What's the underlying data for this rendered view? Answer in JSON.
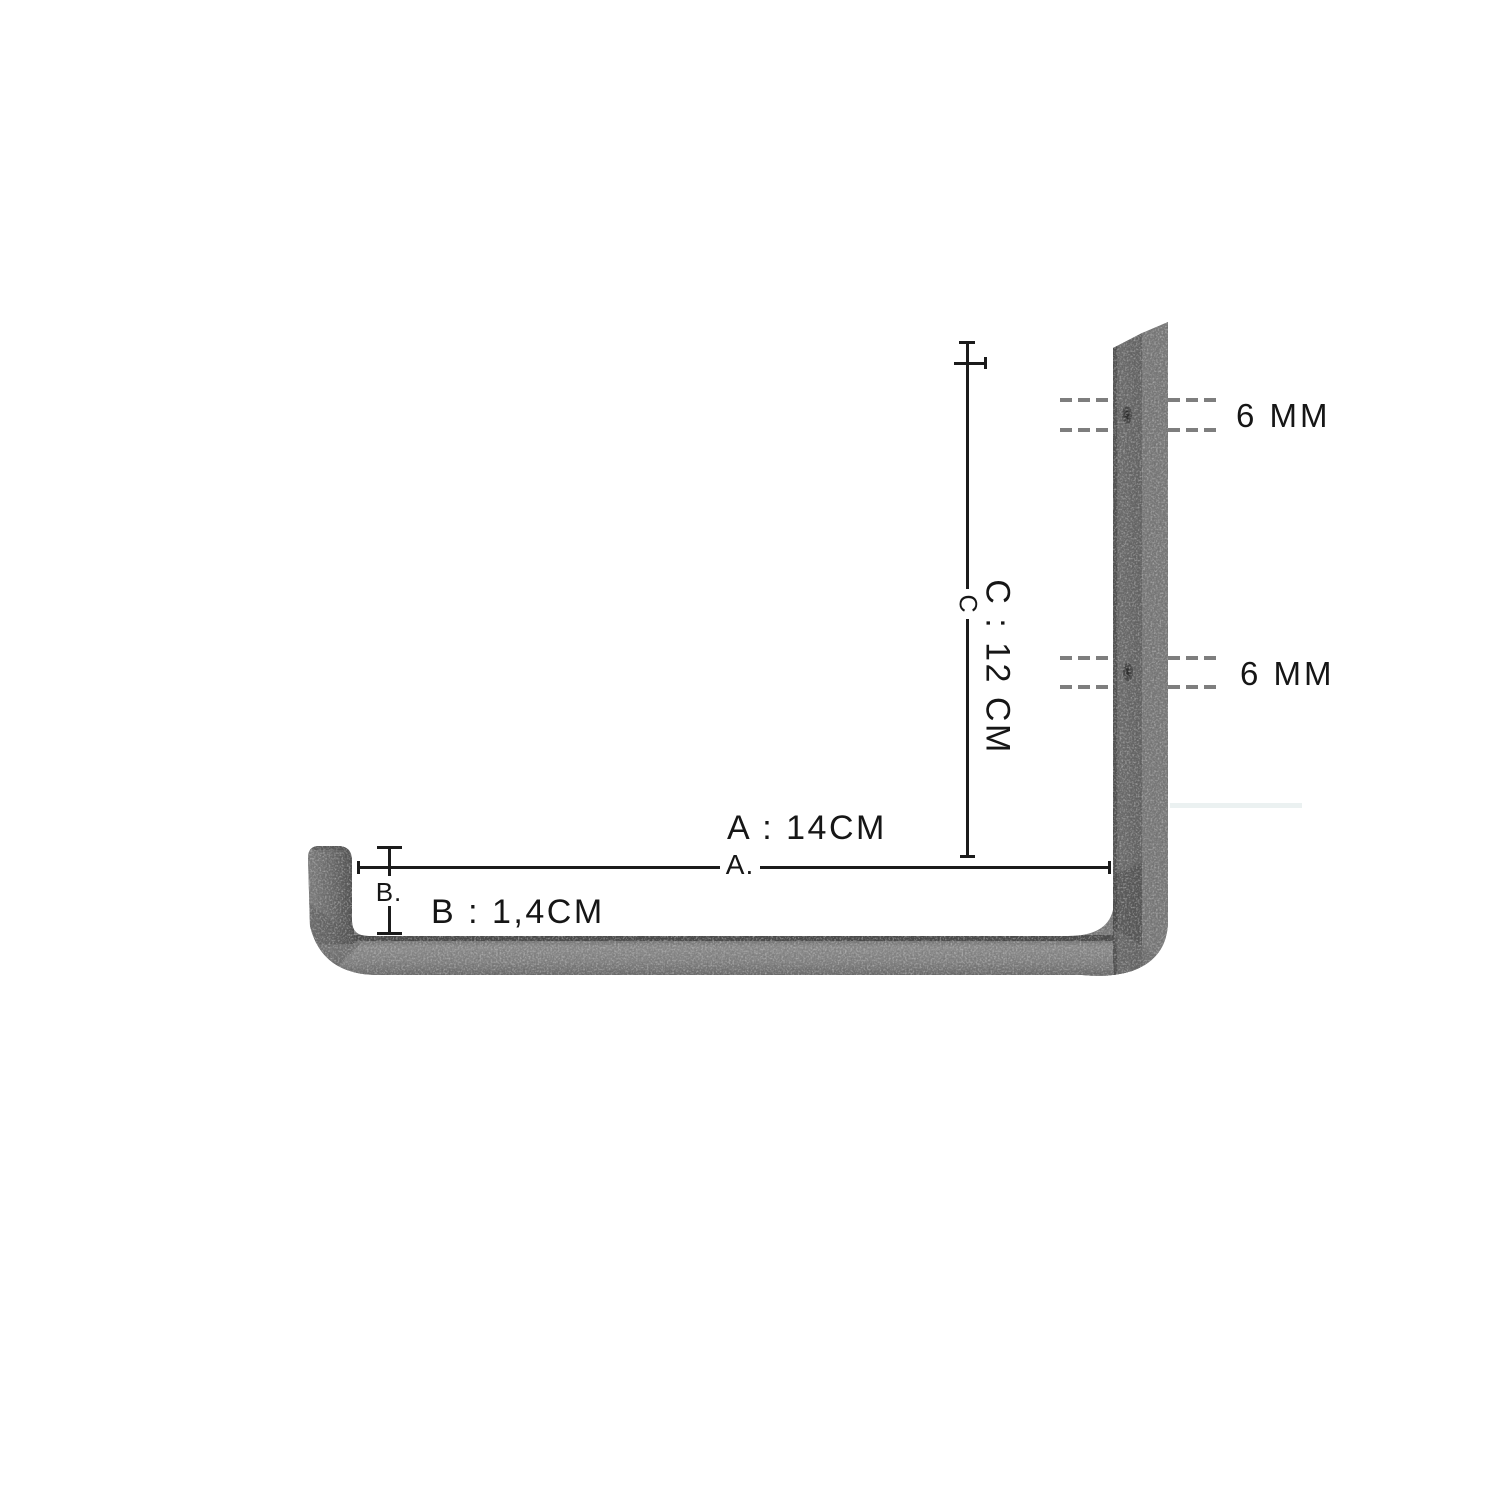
{
  "diagram": {
    "dim_a": {
      "label": "A : 14CM",
      "line_label": "A."
    },
    "dim_b": {
      "label": "B : 1,4CM",
      "line_label": "B."
    },
    "dim_c": {
      "label": "C : 12 CM",
      "line_label": "C"
    },
    "hole_top": {
      "label": "6 MM"
    },
    "hole_bottom": {
      "label": "6 MM"
    },
    "colors": {
      "line": "#1b1b1b",
      "dash": "#7e7e7e",
      "text": "#161616",
      "metal_face": "#6b6b6b",
      "metal_edge": "#7d7d7d",
      "metal_bar": "#868686",
      "background": "#ffffff"
    }
  }
}
